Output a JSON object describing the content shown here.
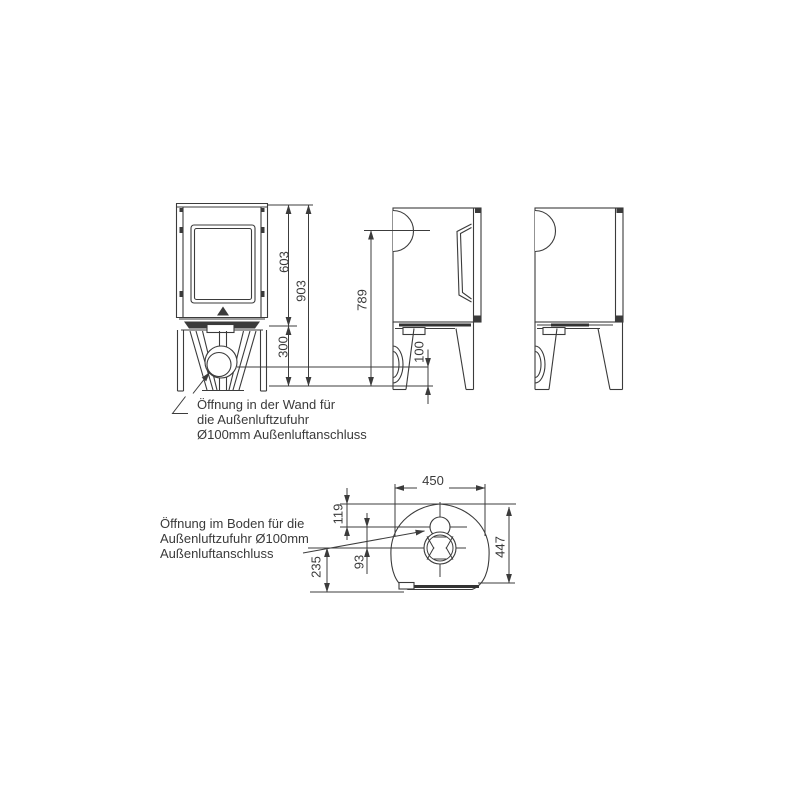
{
  "drawing": {
    "type": "technical-dimension-drawing",
    "subject": "free-standing stove, front view, two side views and bottom view with external air connection",
    "background_color": "#ffffff",
    "line_color": "#3b3b3b",
    "text_color": "#3a3a3a",
    "dimensions_mm": {
      "front_height_to_base_top": "603",
      "total_height": "903",
      "base_height": "300",
      "rear_flue_outlet_center_height": "789",
      "air_inlet_center_height": "100",
      "overall_width": "450",
      "overall_depth": "447",
      "floor_opening_center_from_back": "119",
      "opening_centers_spacing": "93",
      "air_inlet_center_from_front": "235"
    },
    "notes": {
      "wall": [
        "Öffnung in der Wand für",
        "die Außenluftzufuhr",
        "Ø100mm Außenluftanschluss"
      ],
      "floor": [
        "Öffnung im Boden für die",
        "Außenluftzufuhr Ø100mm",
        "Außenluftanschluss"
      ]
    }
  }
}
